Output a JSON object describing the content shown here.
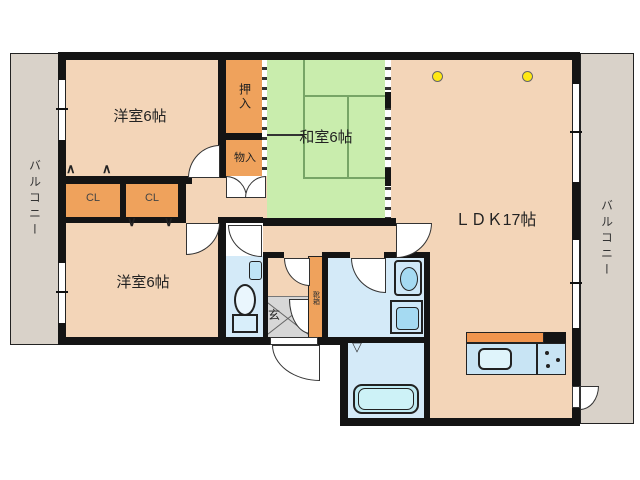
{
  "rooms": {
    "bedroom_top": "洋室6帖",
    "bedroom_bottom": "洋室6帖",
    "japanese_room": "和室6帖",
    "ldk": "ＬＤＫ17帖",
    "oshiire": "押入",
    "monoire": "物入",
    "closet1": "CL",
    "closet2": "CL",
    "genkan": "玄",
    "shoebox": "靴箱",
    "balcony_left": "バルコニー",
    "balcony_right": "バルコニー"
  },
  "door_marks": {
    "up": "∧",
    "down": "∨",
    "fold": "▽"
  },
  "colors": {
    "room_floor": "#f3d5b8",
    "tatami": "#c9edad",
    "closet_orange": "#efa25c",
    "wet_area_blue": "#d4eaf8",
    "balcony_gray": "#d9d2c9",
    "genkan_gray": "#d7d7d7",
    "wall_black": "#141414",
    "kitchen_counter": "#c8e4f4",
    "kitchen_backsplash": "#f0954e",
    "highlight_yellow": "#ffe813"
  }
}
